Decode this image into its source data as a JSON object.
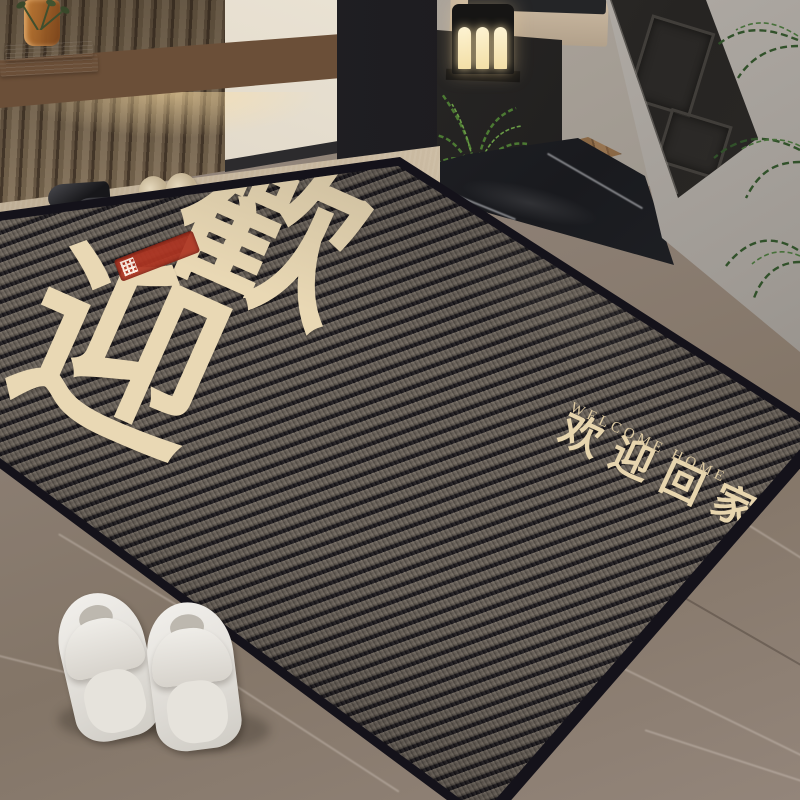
{
  "scene": {
    "type": "entryway product photo",
    "subject": "striped chenille entrance doormat in a home entryway"
  },
  "doormat": {
    "large_characters": [
      "歡",
      "迎"
    ],
    "welcome_cn": "欢迎回家",
    "welcome_en": "WELCOME HOME",
    "colors": {
      "rib_light": "#6f675e",
      "rib_groove": "#17151a",
      "binding": "#14121a",
      "lettering": "#e9d8b4",
      "seal_red": "#b03522"
    }
  },
  "objects": {
    "slat_wall": "wood slat accent wall",
    "console_shelf": "floating walnut shelf with under-glow",
    "marble_books": "stacked marble decor books",
    "glass_vase": "amber glass vase with stems",
    "black_loafers": "pair of black loafers",
    "beige_slippers": "pair of beige slippers",
    "white_slippers": "pair of white slippers",
    "lantern_lamp": "black lantern lamp with warm light",
    "bed": "beige upholstered bed with dark throw",
    "side_cabinet": "dark side cabinet",
    "fern_plant": "green fern plant",
    "palm_plant": "palm fronds",
    "entry_door": "dark paneled open door",
    "stone_threshold": "black marble threshold",
    "marble_floor": "grey-brown marble tile floor",
    "travertine_floor": "beige stone strip along wall"
  }
}
